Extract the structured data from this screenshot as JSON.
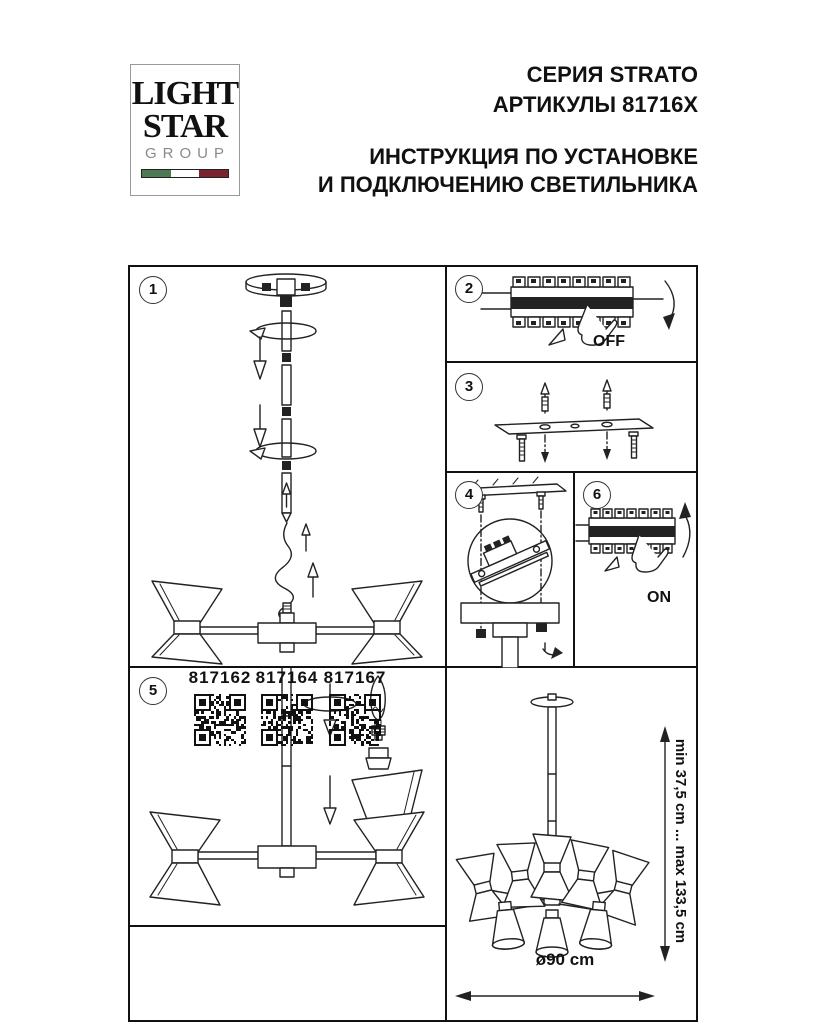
{
  "header": {
    "logo": {
      "line1": "LIGHT",
      "line2": "STAR",
      "line3": "GROUP"
    },
    "series": "СЕРИЯ STRATO",
    "articles": "АРТИКУЛЫ 81716X",
    "instruction_line1": "ИНСТРУКЦИЯ ПО УСТАНОВКЕ",
    "instruction_line2": "И ПОДКЛЮЧЕНИЮ СВЕТИЛЬНИКА"
  },
  "colors": {
    "flag_green": "#4d7a52",
    "flag_white": "#ffffff",
    "flag_red": "#7a2430",
    "line": "#1a1a1a"
  },
  "steps": {
    "step1": {
      "num": "1"
    },
    "step2": {
      "num": "2",
      "label": "OFF"
    },
    "step3": {
      "num": "3"
    },
    "step4": {
      "num": "4"
    },
    "step5": {
      "num": "5"
    },
    "step6": {
      "num": "6",
      "label": "ON"
    }
  },
  "articles_list": {
    "items": [
      "817162",
      "817164",
      "817167"
    ]
  },
  "dimensions": {
    "height_range": "min 37,5 cm ... max 133,5 cm",
    "diameter": "ø90 cm"
  }
}
